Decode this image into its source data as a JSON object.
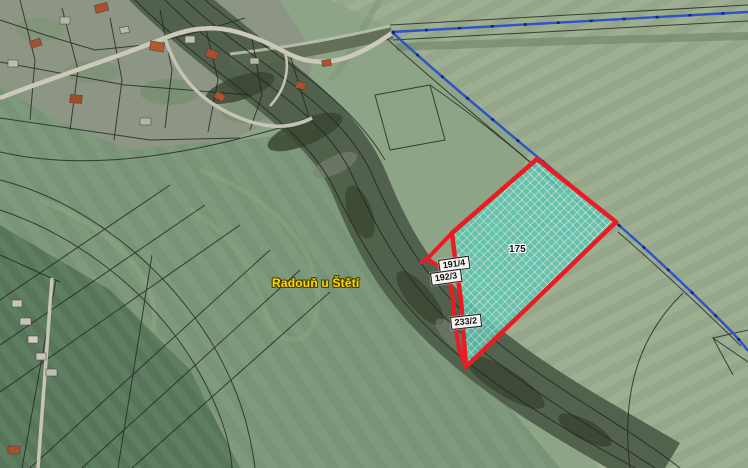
{
  "map": {
    "place_label": "Radouň u Štětí",
    "highlighted_parcel": {
      "number": "175"
    },
    "parcel_labels": [
      {
        "text": "191/4"
      },
      {
        "text": "192/3"
      },
      {
        "text": "233/2"
      }
    ],
    "colors": {
      "highlight_outline": "#ec1a23",
      "highlight_hatch_fill": "#5cc7b2",
      "stream_line": "#2e52c8",
      "place_label_text": "#ffd800",
      "parcel_label_background": "#f7f6f2",
      "cadastral_line": "#20241f"
    }
  }
}
